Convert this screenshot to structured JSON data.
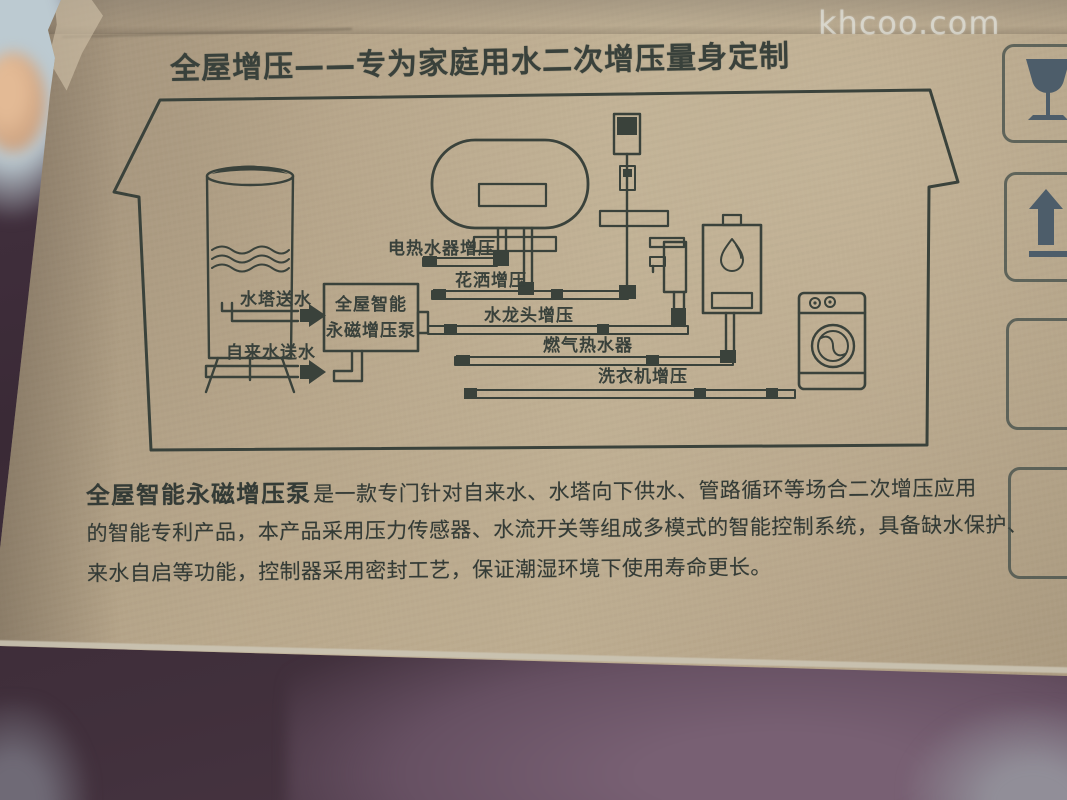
{
  "photo": {
    "watermark": "khcoo.com"
  },
  "panel": {
    "title": "全屋增压——专为家庭用水二次增压量身定制"
  },
  "diagram": {
    "inputs": {
      "water_tower": "水塔送水",
      "tap_water": "自来水送水"
    },
    "pump": {
      "line1": "全屋智能",
      "line2": "永磁增压泵"
    },
    "branches": {
      "electric_heater": "电热水器增压",
      "shower": "花洒增压",
      "faucet": "水龙头增压",
      "gas_heater": "燃气热水器",
      "washer": "洗衣机增压"
    }
  },
  "description": {
    "lead": "全屋智能永磁增压泵",
    "line1": "是一款专门针对自来水、水塔向下供水、管路循环等场合二次增压应用",
    "line2": "的智能专利产品，本产品采用压力传感器、水流开关等组成多模式的智能控制系统，具备缺水保护、",
    "line3": "来水自启等功能，控制器采用密封工艺，保证潮湿环境下使用寿命更长。"
  },
  "symbols": {
    "first": "fragile",
    "second": "this-way-up"
  },
  "colors": {
    "ink": "#3a423b",
    "cardboard": "#b5a489",
    "symbol_ink": "#4d5d6a",
    "bg_dark": "#3a2a36",
    "bg_mauve": "#6b5467"
  }
}
